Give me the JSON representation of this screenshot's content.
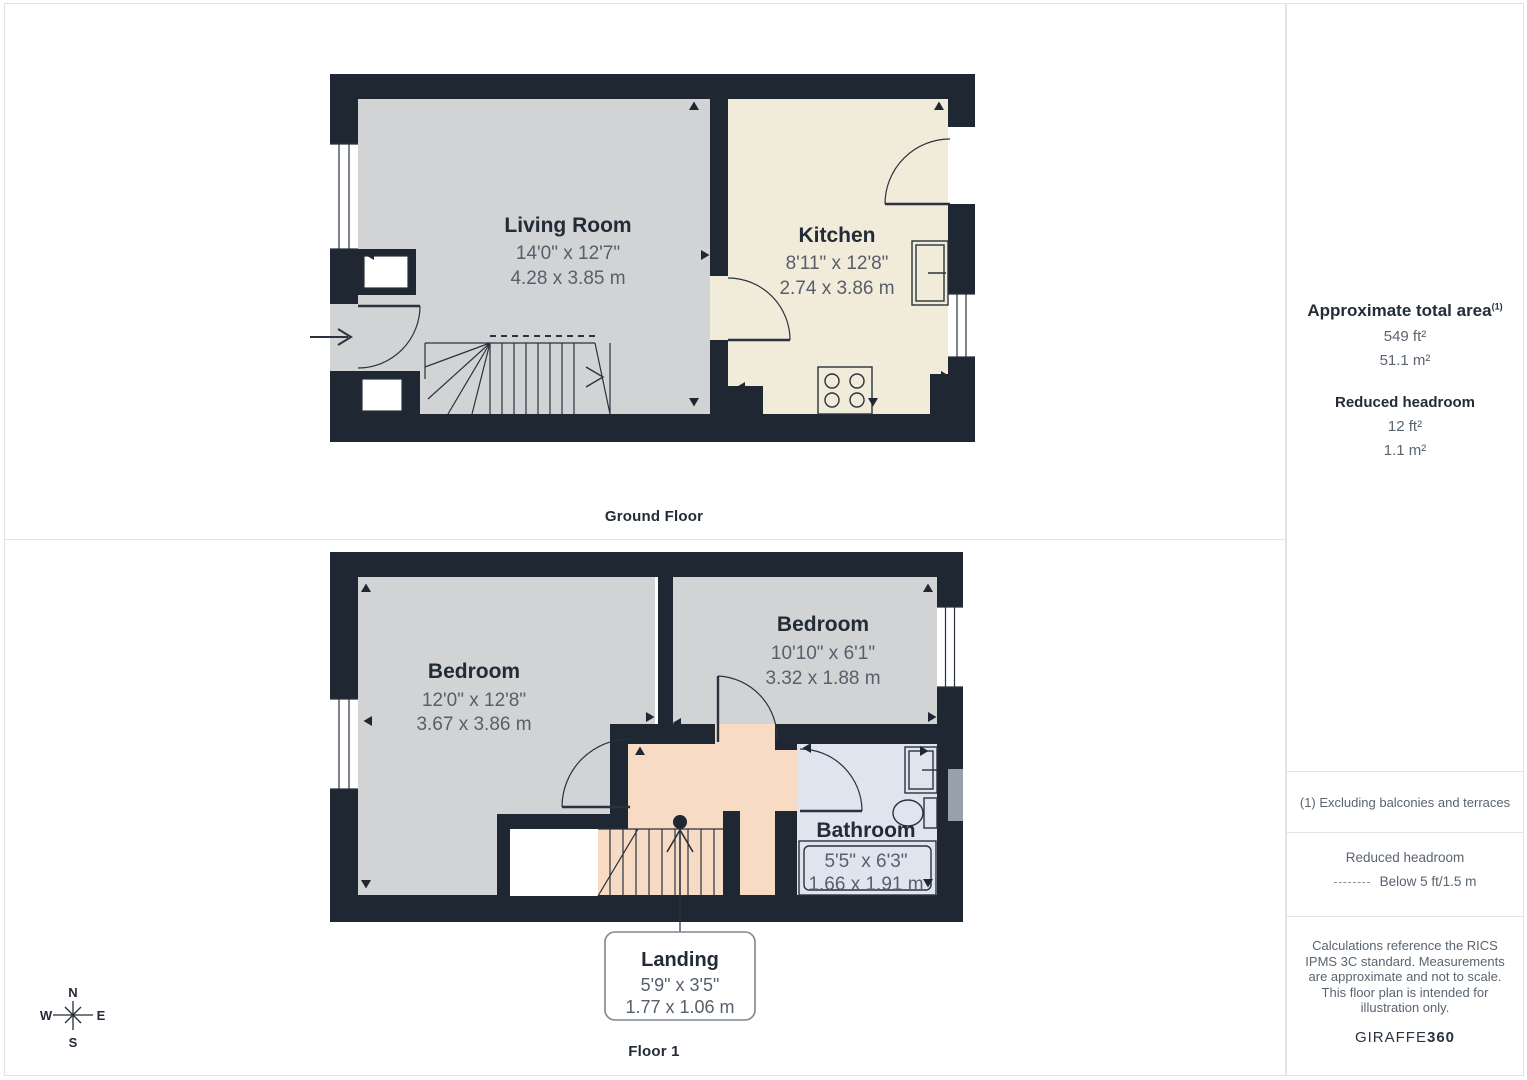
{
  "floors": [
    {
      "caption": "Ground Floor",
      "rooms": [
        {
          "name": "Living Room",
          "dims_ft": "14'0\" x 12'7\"",
          "dims_m": "4.28 x 3.85 m"
        },
        {
          "name": "Kitchen",
          "dims_ft": "8'11\" x 12'8\"",
          "dims_m": "2.74 x 3.86 m"
        }
      ]
    },
    {
      "caption": "Floor 1",
      "rooms": [
        {
          "name": "Bedroom",
          "dims_ft": "12'0\" x 12'8\"",
          "dims_m": "3.67 x 3.86 m"
        },
        {
          "name": "Bedroom",
          "dims_ft": "10'10\" x 6'1\"",
          "dims_m": "3.32 x 1.88 m"
        },
        {
          "name": "Bathroom",
          "dims_ft": "5'5\" x 6'3\"",
          "dims_m": "1.66 x 1.91 m"
        },
        {
          "name": "Landing",
          "dims_ft": "5'9\" x 3'5\"",
          "dims_m": "1.77 x 1.06 m"
        }
      ]
    }
  ],
  "sidebar": {
    "total_area_label": "Approximate total area",
    "total_area_sup": "(1)",
    "total_area_ft": "549 ft²",
    "total_area_m": "51.1 m²",
    "reduced_label": "Reduced headroom",
    "reduced_ft": "12 ft²",
    "reduced_m": "1.1 m²",
    "footnote": "(1) Excluding balconies and terraces",
    "legend_title": "Reduced headroom",
    "legend_item": "Below 5 ft/1.5 m",
    "disclaimer": "Calculations reference the RICS IPMS 3C standard. Measurements are approximate and not to scale. This floor plan is intended for illustration only.",
    "brand_normal": "GIRAFFE",
    "brand_bold": "360"
  },
  "compass": {
    "n": "N",
    "s": "S",
    "w": "W",
    "e": "E"
  },
  "colors": {
    "wall": "#1f2733",
    "room_gray": "#d2d3d5",
    "kitchen_cream": "#f1ebd9",
    "landing_peach": "#f8dbc5",
    "bathroom_blue": "#dfe4ee",
    "line": "#29323e",
    "title_text": "#222b36",
    "dim_text": "#565f6b",
    "muted_text": "#5a6470",
    "border": "#e3e3e3",
    "headroom_gray": "#98a0aa"
  }
}
